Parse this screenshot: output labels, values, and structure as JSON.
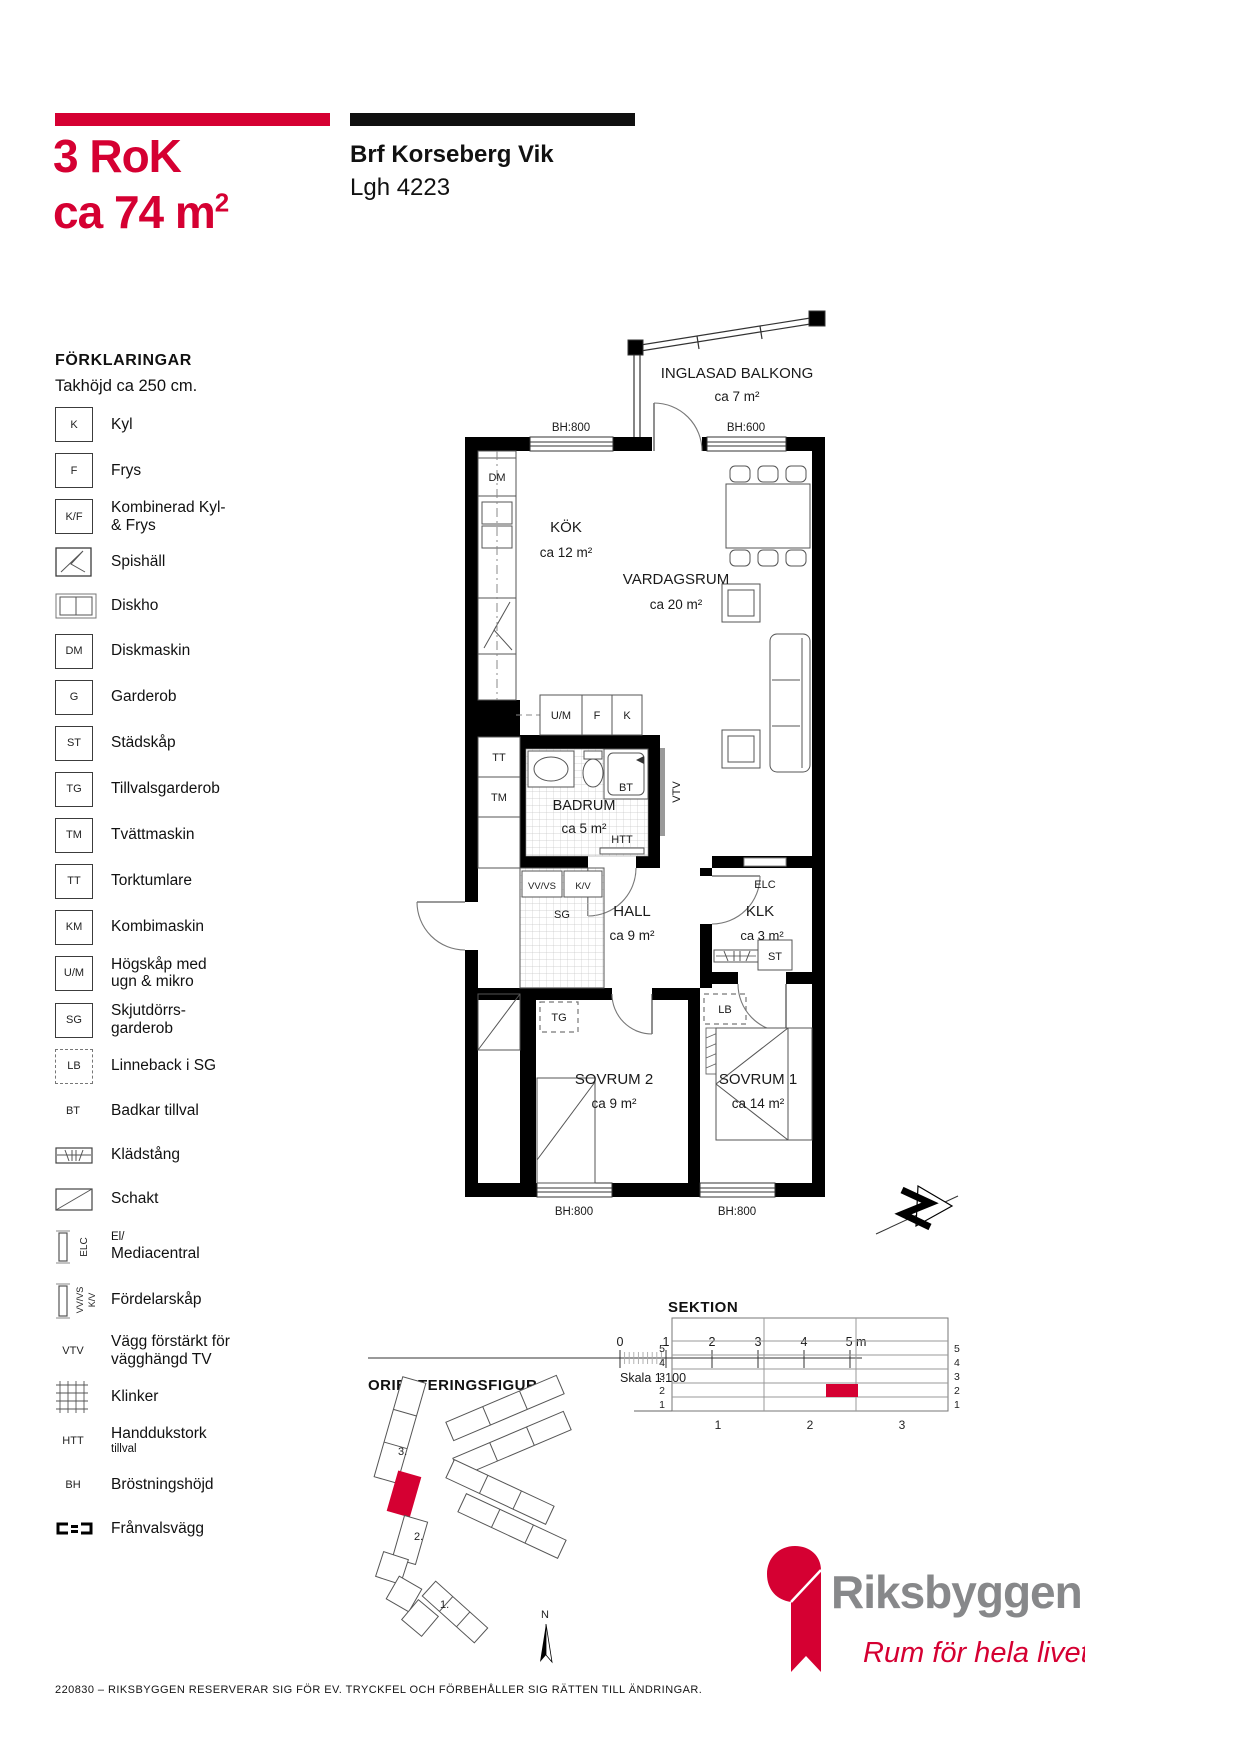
{
  "header": {
    "title_line1": "3 RoK",
    "title_line2_prefix": "ca 74 m",
    "title_sup": "2",
    "project_name": "Brf Korseberg Vik",
    "apartment_no": "Lgh 4223"
  },
  "legend": {
    "title": "FÖRKLARINGAR",
    "subtitle": "Takhöjd ca 250 cm.",
    "items": [
      {
        "sym": "K",
        "label": "Kyl"
      },
      {
        "sym": "F",
        "label": "Frys"
      },
      {
        "sym": "K/F",
        "label": "Kombinerad Kyl-",
        "label2": "& Frys"
      },
      {
        "sym": "",
        "label": "Spishäll"
      },
      {
        "sym": "",
        "label": "Diskho"
      },
      {
        "sym": "DM",
        "label": "Diskmaskin"
      },
      {
        "sym": "G",
        "label": "Garderob"
      },
      {
        "sym": "ST",
        "label": "Städskåp"
      },
      {
        "sym": "TG",
        "label": "Tillvalsgarderob"
      },
      {
        "sym": "TM",
        "label": "Tvättmaskin"
      },
      {
        "sym": "TT",
        "label": "Torktumlare"
      },
      {
        "sym": "KM",
        "label": "Kombimaskin"
      },
      {
        "sym": "U/M",
        "label": "Högskåp med",
        "label2": "ugn & mikro"
      },
      {
        "sym": "SG",
        "label": "Skjutdörrs-",
        "label2": "garderob"
      },
      {
        "sym": "LB",
        "label": "Linneback i SG"
      },
      {
        "sym": "BT",
        "label": "Badkar tillval"
      },
      {
        "sym": "",
        "label": "Klädstång"
      },
      {
        "sym": "",
        "label": "Schakt"
      },
      {
        "sym": "ELC",
        "label": "El/",
        "label2": "Mediacentral"
      },
      {
        "sym": "VV/VS",
        "sym2": "K/V",
        "label": "Fördelarskåp"
      },
      {
        "sym": "VTV",
        "label": "Vägg förstärkt för",
        "label2": "vägghängd TV"
      },
      {
        "sym": "",
        "label": "Klinker"
      },
      {
        "sym": "HTT",
        "label": "Handdukstork",
        "label2": "tillval"
      },
      {
        "sym": "BH",
        "label": "Bröstningshöjd"
      },
      {
        "sym": "",
        "label": "Frånvalsvägg"
      }
    ]
  },
  "plan": {
    "rooms": [
      {
        "name": "INGLASAD BALKONG",
        "area": "ca 7 m²"
      },
      {
        "name": "KÖK",
        "area": "ca 12 m²"
      },
      {
        "name": "VARDAGSRUM",
        "area": "ca 20 m²"
      },
      {
        "name": "BADRUM",
        "area": "ca 5 m²"
      },
      {
        "name": "HALL",
        "area": "ca 9 m²"
      },
      {
        "name": "KLK",
        "area": "ca 3 m²"
      },
      {
        "name": "SOVRUM 2",
        "area": "ca 9 m²"
      },
      {
        "name": "SOVRUM 1",
        "area": "ca 14 m²"
      }
    ],
    "bh_top_left": "BH:800",
    "bh_top_right": "BH:600",
    "bh_bottom_left": "BH:800",
    "bh_bottom_right": "BH:800",
    "markers": {
      "dm": "DM",
      "um": "U/M",
      "f": "F",
      "k": "K",
      "tt": "TT",
      "tm": "TM",
      "bt": "BT",
      "htt": "HTT",
      "vtv": "VTV",
      "vvvs": "VV/VS",
      "kv": "K/V",
      "sg": "SG",
      "elc": "ELC",
      "st": "ST",
      "tg": "TG",
      "lb": "LB"
    }
  },
  "scale_bar": {
    "ticks": [
      "0",
      "1",
      "2",
      "3",
      "4",
      "5 m"
    ],
    "caption": "Skala 1:100"
  },
  "orientering": {
    "title": "ORIENTERINGSFIGUR",
    "labels": [
      "3.",
      "2.",
      "1."
    ],
    "north": "N"
  },
  "sektion": {
    "title": "SEKTION",
    "row_labels": [
      "5",
      "4",
      "3",
      "2",
      "1"
    ],
    "col_labels": [
      "1",
      "2",
      "3"
    ]
  },
  "brand": {
    "name": "Riksbyggen",
    "tagline": "Rum för hela livet"
  },
  "footer": {
    "disclaimer": "220830 – RIKSBYGGEN RESERVERAR SIG FÖR EV. TRYCKFEL OCH FÖRBEHÅLLER SIG RÄTTEN TILL ÄNDRINGAR."
  },
  "colors": {
    "red": "#d50032",
    "logo_gray": "#87888a"
  }
}
